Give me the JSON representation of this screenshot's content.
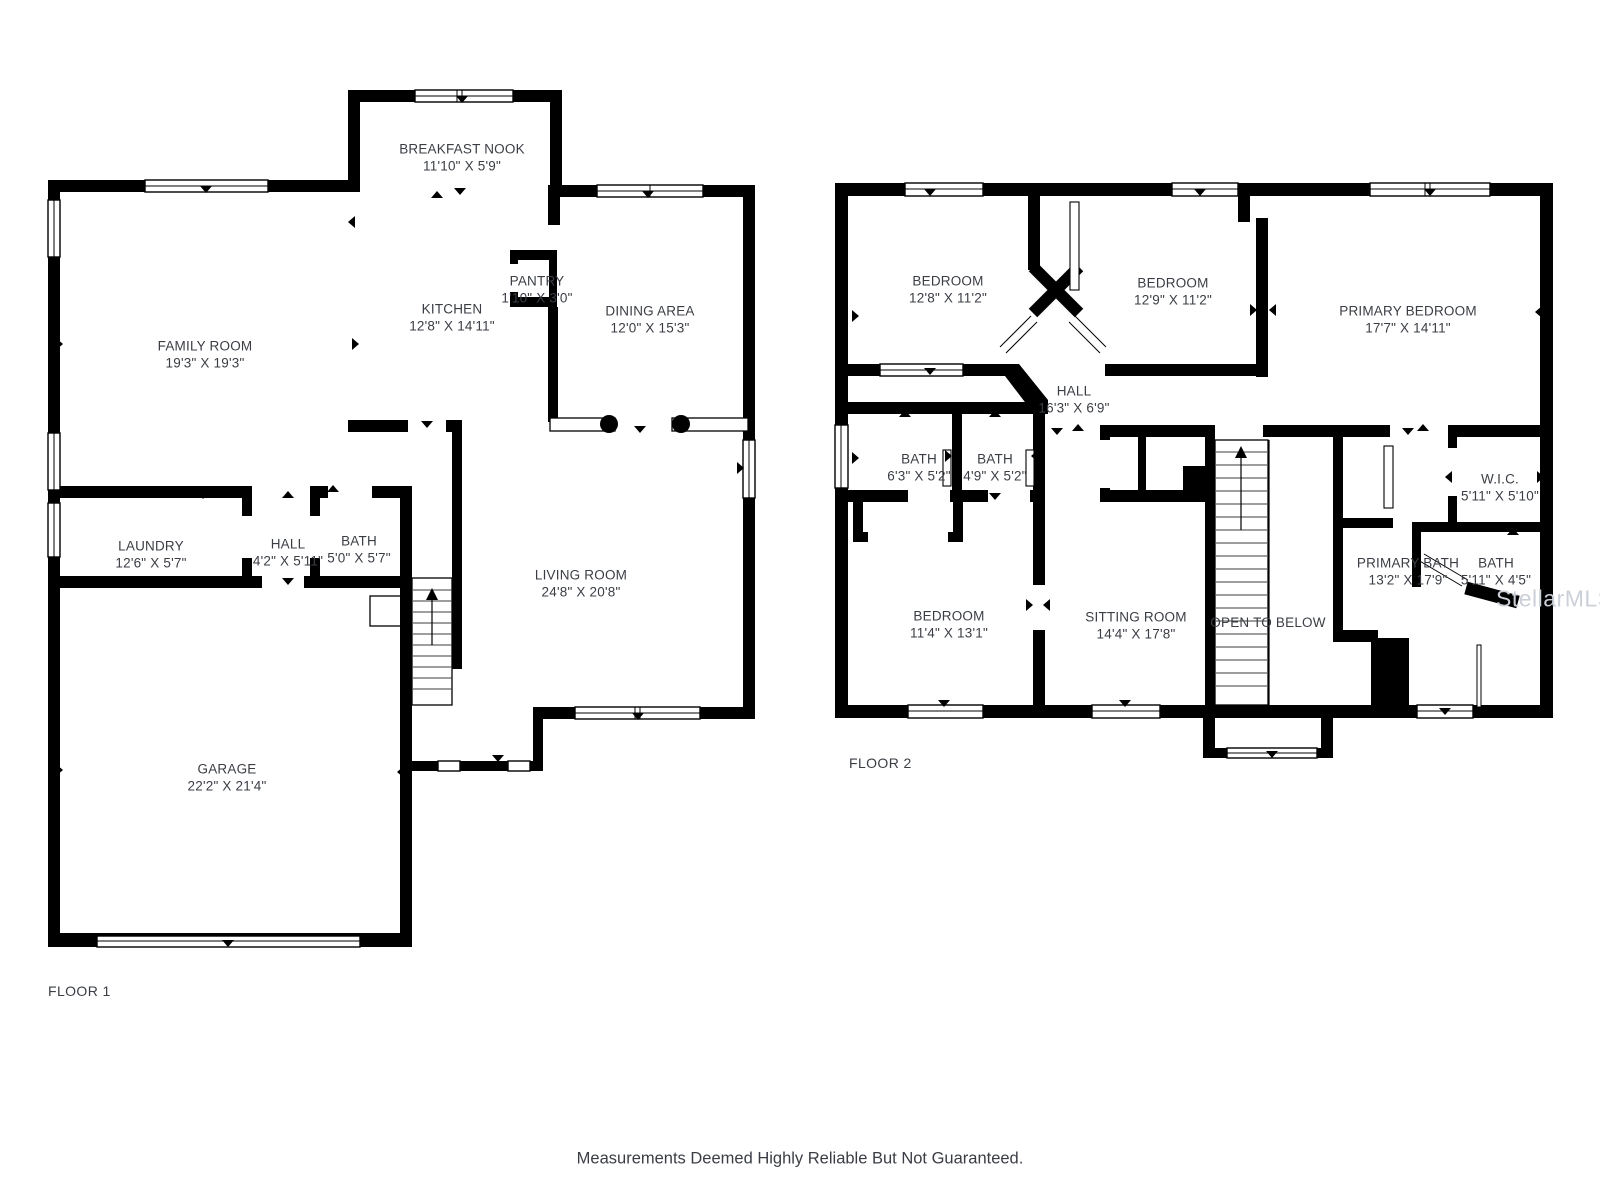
{
  "colors": {
    "wall": "#000000",
    "background": "#ffffff",
    "label_text": "#3a3e44"
  },
  "floor1": {
    "label": "FLOOR 1",
    "label_pos": {
      "x": 48,
      "y": 991
    },
    "rooms": [
      {
        "name": "BREAKFAST NOOK",
        "dims": "11'10\" X 5'9\"",
        "cx": 462,
        "cy": 150
      },
      {
        "name": "FAMILY ROOM",
        "dims": "19'3\" X 19'3\"",
        "cx": 205,
        "cy": 347
      },
      {
        "name": "KITCHEN",
        "dims": "12'8\" X 14'11\"",
        "cx": 452,
        "cy": 310
      },
      {
        "name": "PANTRY",
        "dims": "1'10\" X 3'0\"",
        "cx": 537,
        "cy": 282
      },
      {
        "name": "DINING AREA",
        "dims": "12'0\" X 15'3\"",
        "cx": 650,
        "cy": 312
      },
      {
        "name": "LAUNDRY",
        "dims": "12'6\" X 5'7\"",
        "cx": 151,
        "cy": 547
      },
      {
        "name": "HALL",
        "dims": "4'2\" X 5'11\"",
        "cx": 288,
        "cy": 545
      },
      {
        "name": "BATH",
        "dims": "5'0\" X 5'7\"",
        "cx": 359,
        "cy": 542
      },
      {
        "name": "LIVING ROOM",
        "dims": "24'8\" X 20'8\"",
        "cx": 581,
        "cy": 576
      },
      {
        "name": "GARAGE",
        "dims": "22'2\" X 21'4\"",
        "cx": 227,
        "cy": 770
      }
    ]
  },
  "floor2": {
    "label": "FLOOR 2",
    "label_pos": {
      "x": 849,
      "y": 763
    },
    "rooms": [
      {
        "name": "BEDROOM",
        "dims": "12'8\" X 11'2\"",
        "cx": 948,
        "cy": 282
      },
      {
        "name": "BEDROOM",
        "dims": "12'9\" X 11'2\"",
        "cx": 1173,
        "cy": 284
      },
      {
        "name": "PRIMARY BEDROOM",
        "dims": "17'7\" X 14'11\"",
        "cx": 1408,
        "cy": 312
      },
      {
        "name": "HALL",
        "dims": "16'3\" X 6'9\"",
        "cx": 1074,
        "cy": 392
      },
      {
        "name": "BATH",
        "dims": "6'3\" X 5'2\"",
        "cx": 919,
        "cy": 460
      },
      {
        "name": "BATH",
        "dims": "4'9\" X 5'2\"",
        "cx": 995,
        "cy": 460
      },
      {
        "name": "W.I.C.",
        "dims": "5'11\" X 5'10\"",
        "cx": 1500,
        "cy": 480
      },
      {
        "name": "PRIMARY BATH",
        "dims": "13'2\" X 17'9\"",
        "cx": 1408,
        "cy": 564
      },
      {
        "name": "BATH",
        "dims": "5'11\" X 4'5\"",
        "cx": 1496,
        "cy": 564
      },
      {
        "name": "BEDROOM",
        "dims": "11'4\" X 13'1\"",
        "cx": 949,
        "cy": 617
      },
      {
        "name": "SITTING ROOM",
        "dims": "14'4\" X 17'8\"",
        "cx": 1136,
        "cy": 618
      },
      {
        "name": "OPEN TO BELOW",
        "dims": "",
        "cx": 1268,
        "cy": 623
      }
    ]
  },
  "footer": {
    "disclaimer": "Measurements Deemed Highly Reliable But Not Guaranteed.",
    "pos": {
      "x": 800,
      "y": 1159
    }
  },
  "watermark": {
    "text": "StellarMLS",
    "color": "#cbd0d8",
    "pos": {
      "x": 1496,
      "y": 599
    }
  }
}
